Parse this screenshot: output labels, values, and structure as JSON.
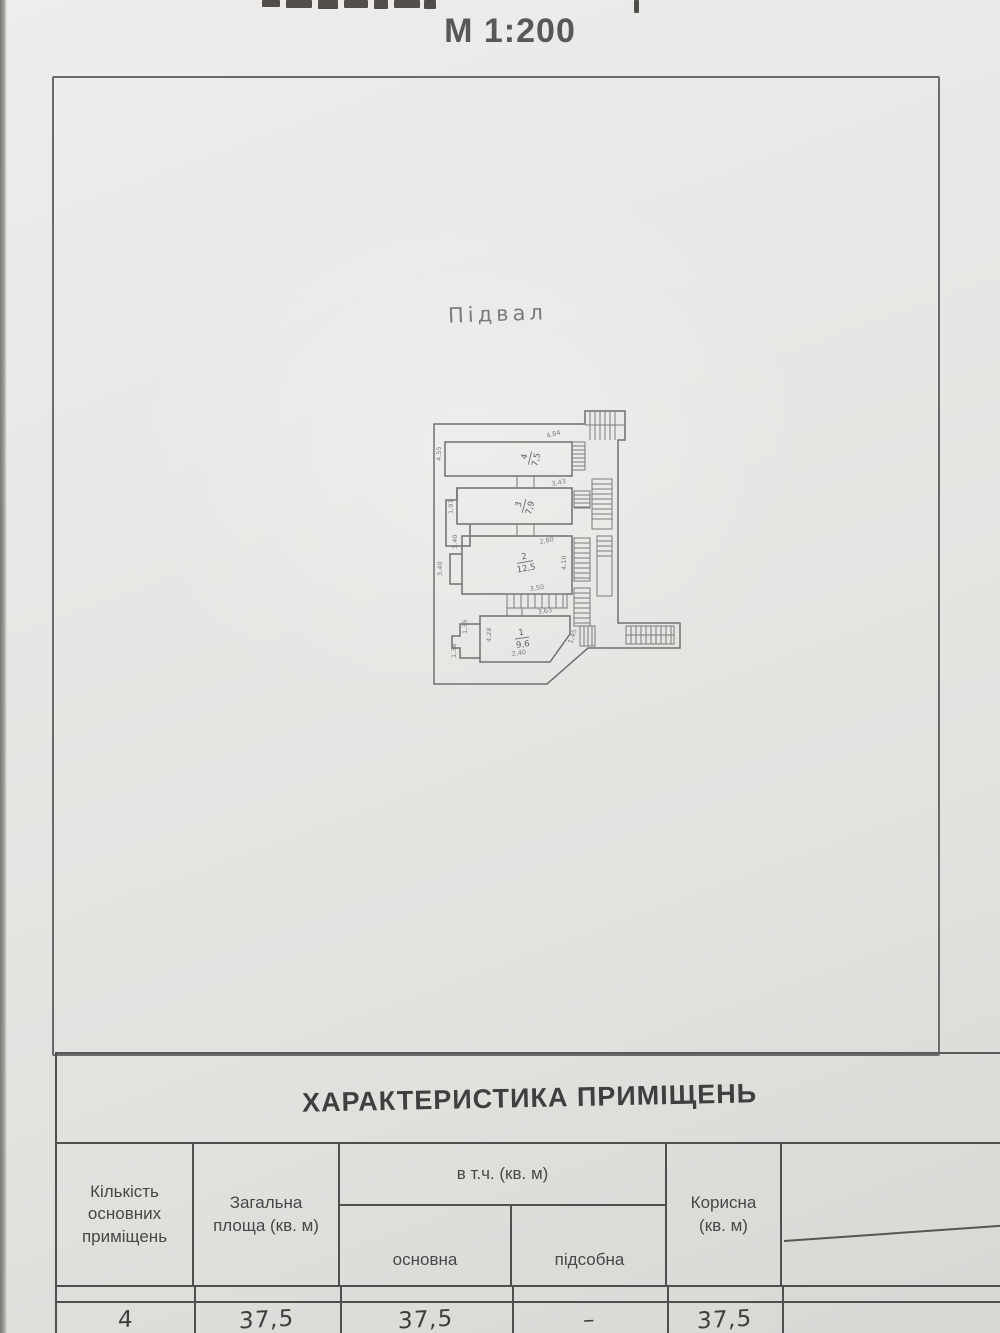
{
  "header": {
    "scale": "М 1:200"
  },
  "plan": {
    "caption": "Підвал",
    "rooms": [
      {
        "num": "4",
        "area": "7,5"
      },
      {
        "num": "3",
        "area": "7,9"
      },
      {
        "num": "2",
        "area": "12,5"
      },
      {
        "num": "1",
        "area": "9,6"
      }
    ],
    "dims": [
      "4,55",
      "4,84",
      "1,97",
      "3,43",
      "1,40",
      "3,40",
      "2,80",
      "4,10",
      "3,50",
      "3,63",
      "4,28",
      "1,35",
      "1,38",
      "2,40",
      "1,45"
    ]
  },
  "table": {
    "title": "ХАРАКТЕРИСТИКА ПРИМІЩЕНЬ",
    "columns": {
      "col1": "Кількість основних приміщень",
      "col2": "Загальна площа (кв. м)",
      "group": "в т.ч. (кв. м)",
      "sub1": "основна",
      "sub2": "підсобна",
      "col5": "Корисна (кв. м)"
    },
    "row": {
      "count": "4",
      "total": "37,5",
      "main": "37,5",
      "aux": "–",
      "useful": "37,5"
    }
  }
}
